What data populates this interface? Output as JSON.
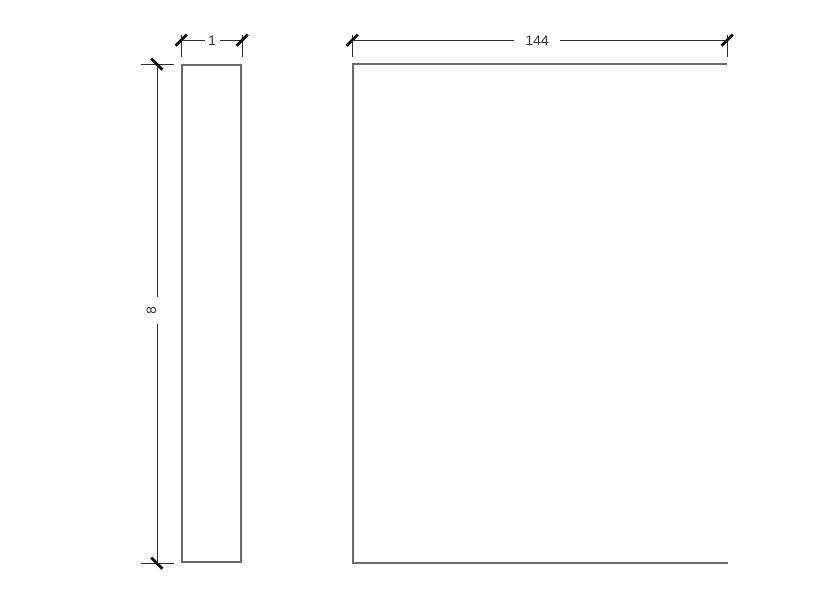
{
  "drawing": {
    "type": "cad-dimension-drawing",
    "colors": {
      "shape_line": "#6b6b6b",
      "dimension_line": "#2e2e2e",
      "tick": "#111111",
      "text": "#333333",
      "background": "#ffffff"
    },
    "views": {
      "edge_view": {
        "name": "edge-view",
        "width_label": "1",
        "height_label": "8"
      },
      "face_view": {
        "name": "face-view",
        "width_label": "144"
      }
    }
  }
}
